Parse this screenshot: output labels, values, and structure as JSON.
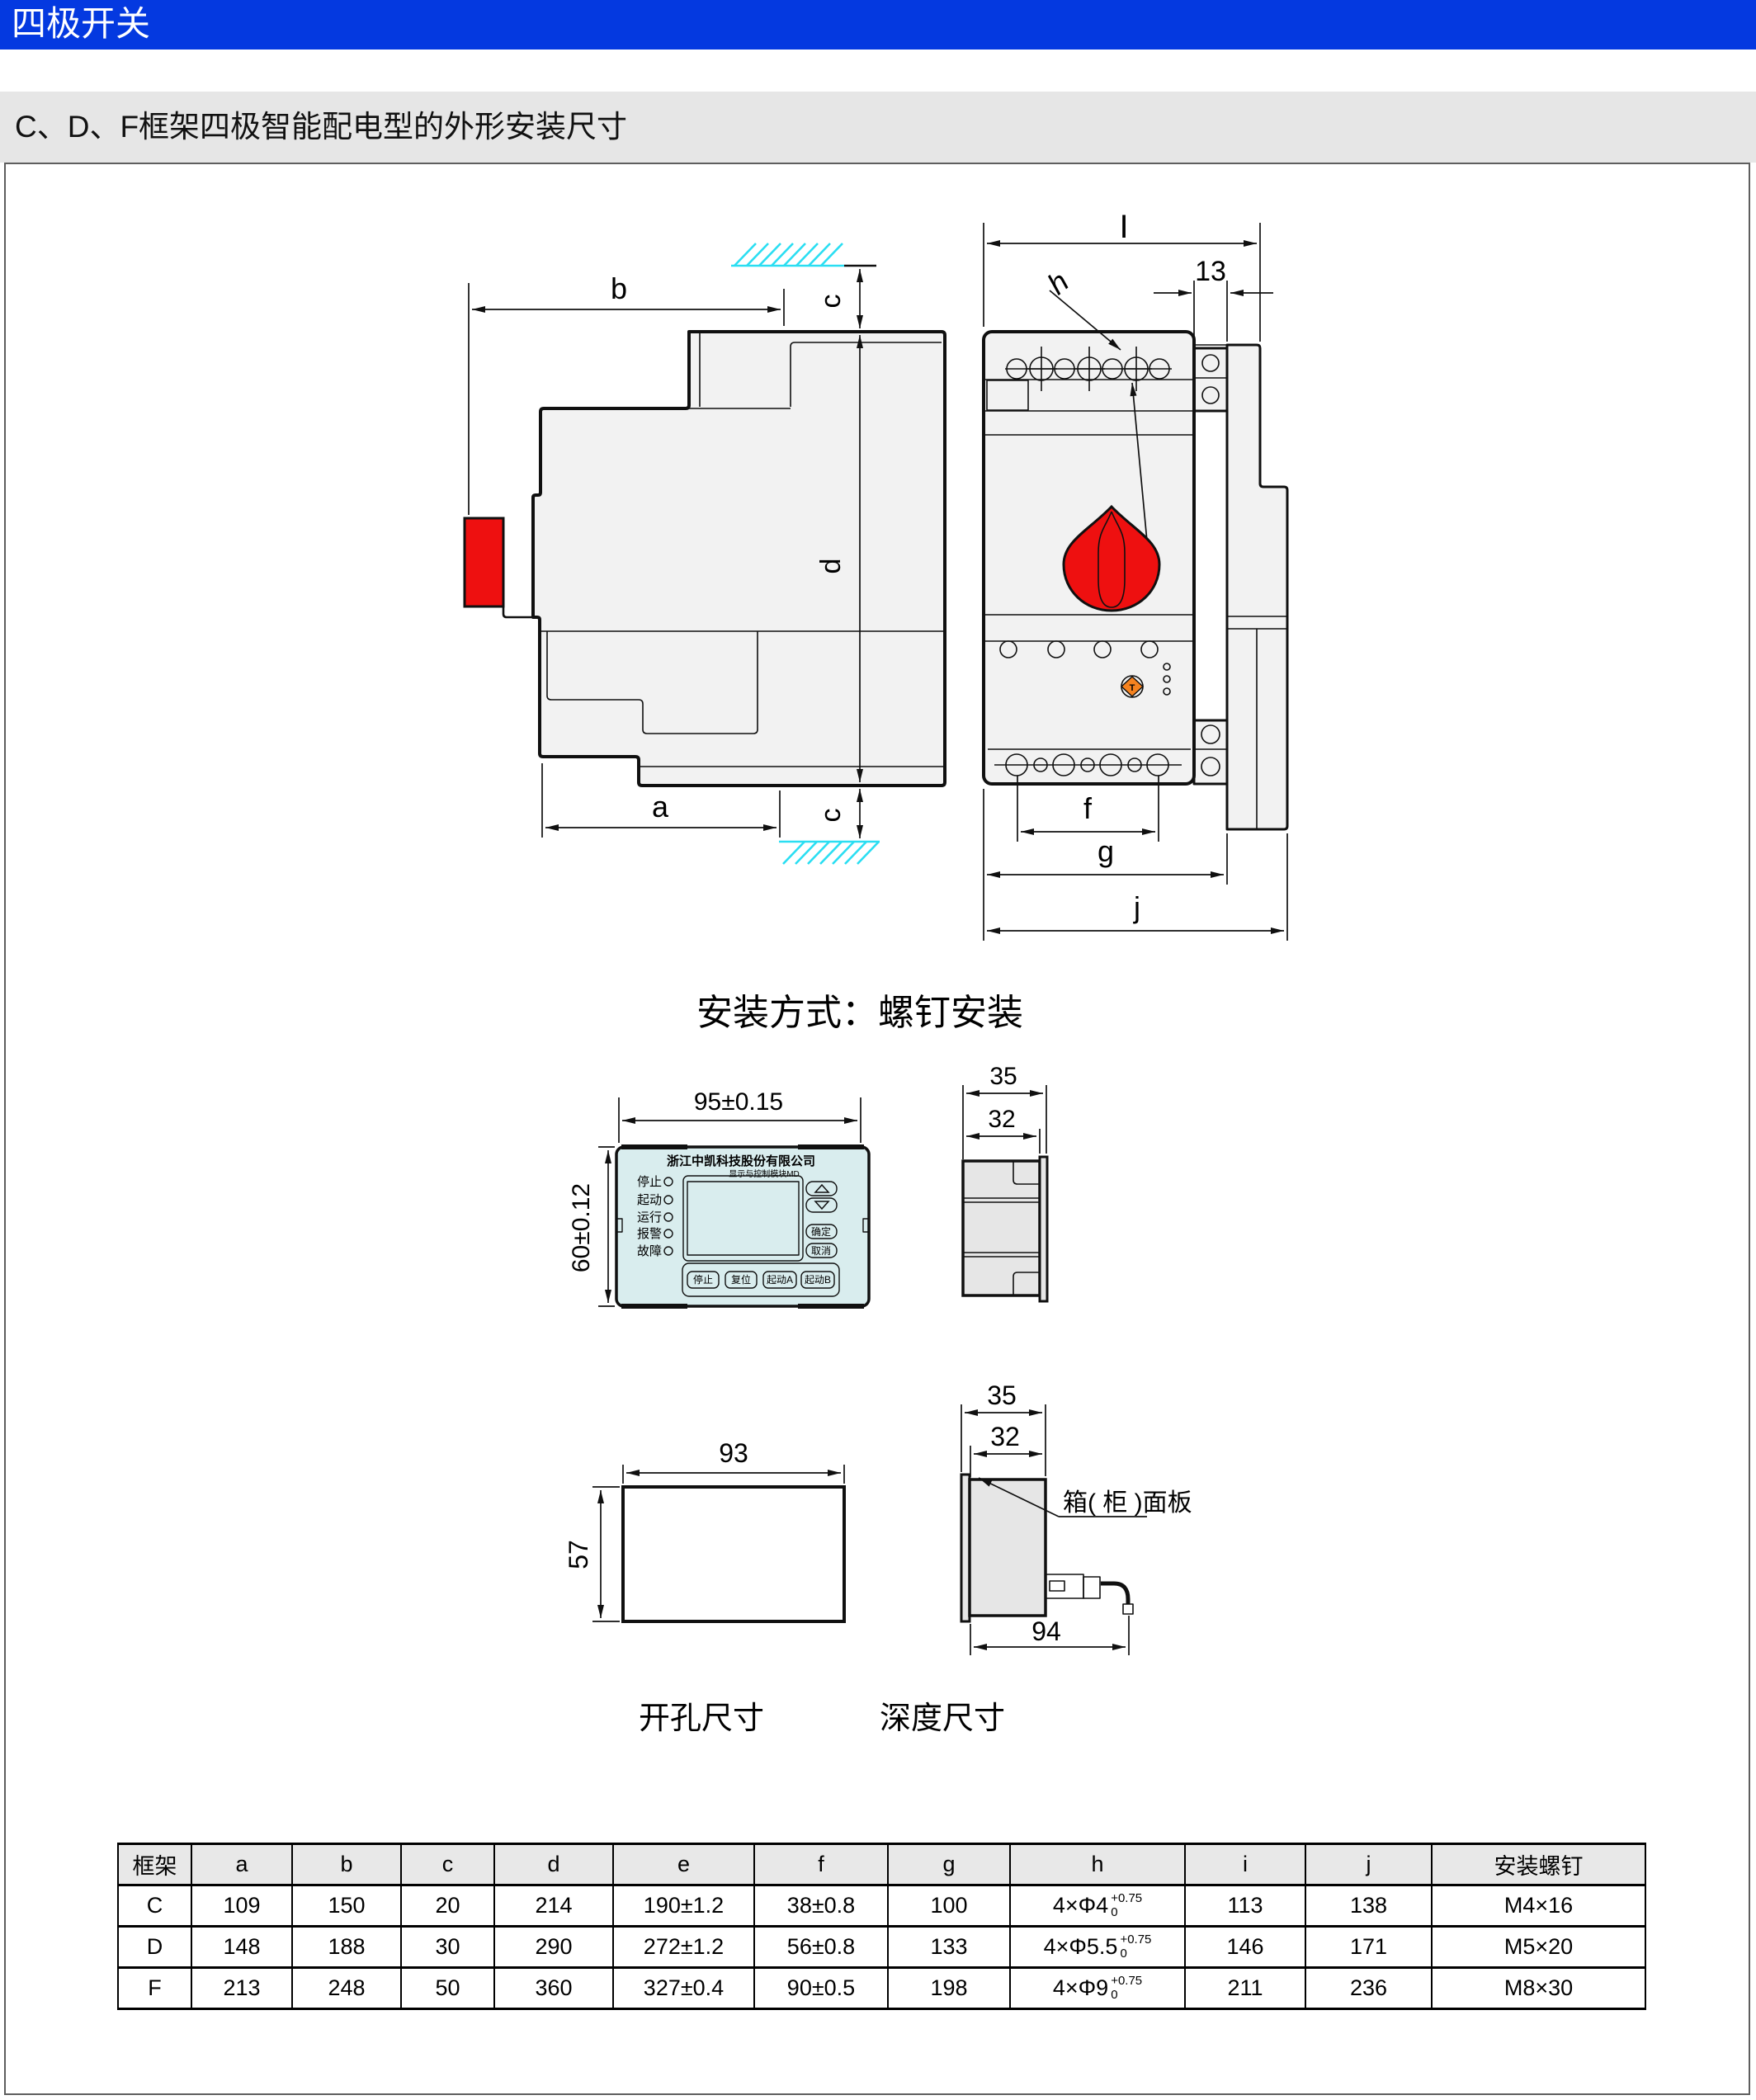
{
  "page": {
    "header_title": "四极开关",
    "subtitle": "C、D、F框架四极智能配电型的外形安装尺寸"
  },
  "colors": {
    "header_blue": "#0439e0",
    "hatch_cyan": "#2adef2",
    "handle_red": "#ee1010",
    "panel_cyan": "#d9edee",
    "button_orange": "#f5821f"
  },
  "captions": {
    "mount": "安装方式：螺钉安装",
    "cutout": "开孔尺寸",
    "depth": "深度尺寸"
  },
  "figures": {
    "side_view": {
      "dim_a": "a",
      "dim_b": "b",
      "dim_c": "c",
      "dim_d": "d"
    },
    "front_view": {
      "dim_I": "I",
      "dim_13": "13",
      "dim_h": "h",
      "dim_f": "f",
      "dim_g": "g",
      "dim_j": "j",
      "test_button_label": "T"
    },
    "panel": {
      "dim_width": "95±0.15",
      "dim_height": "60±0.12",
      "dim_depth_total": "35",
      "dim_depth_body": "32",
      "company": "浙江中凯科技股份有限公司",
      "module": "显示与控制模块MD",
      "leds": [
        "停止",
        "起动",
        "运行",
        "报警",
        "故障"
      ],
      "btn_ok": "确定",
      "btn_cancel": "取消",
      "btn_stop": "停止",
      "btn_reset": "复位",
      "btn_startA": "起动A",
      "btn_startB": "起动B"
    },
    "cutout": {
      "dim_w": "93",
      "dim_h": "57"
    },
    "depth": {
      "dim_total": "35",
      "dim_body": "32",
      "dim_depth": "94",
      "panel_label": "箱( 柜 )面板"
    }
  },
  "table": {
    "headers": [
      "框架",
      "a",
      "b",
      "c",
      "d",
      "e",
      "f",
      "g",
      "h",
      "i",
      "j",
      "安装螺钉"
    ],
    "rows": [
      {
        "frame": "C",
        "a": "109",
        "b": "150",
        "c": "20",
        "d": "214",
        "e": "190±1.2",
        "f": "38±0.8",
        "g": "100",
        "h": {
          "base": "4×Φ4",
          "sup": "+0.75",
          "sub": "0"
        },
        "i": "113",
        "j": "138",
        "screw": "M4×16"
      },
      {
        "frame": "D",
        "a": "148",
        "b": "188",
        "c": "30",
        "d": "290",
        "e": "272±1.2",
        "f": "56±0.8",
        "g": "133",
        "h": {
          "base": "4×Φ5.5",
          "sup": "+0.75",
          "sub": "0"
        },
        "i": "146",
        "j": "171",
        "screw": "M5×20"
      },
      {
        "frame": "F",
        "a": "213",
        "b": "248",
        "c": "50",
        "d": "360",
        "e": "327±0.4",
        "f": "90±0.5",
        "g": "198",
        "h": {
          "base": "4×Φ9",
          "sup": "+0.75",
          "sub": "0"
        },
        "i": "211",
        "j": "236",
        "screw": "M8×30"
      }
    ]
  }
}
